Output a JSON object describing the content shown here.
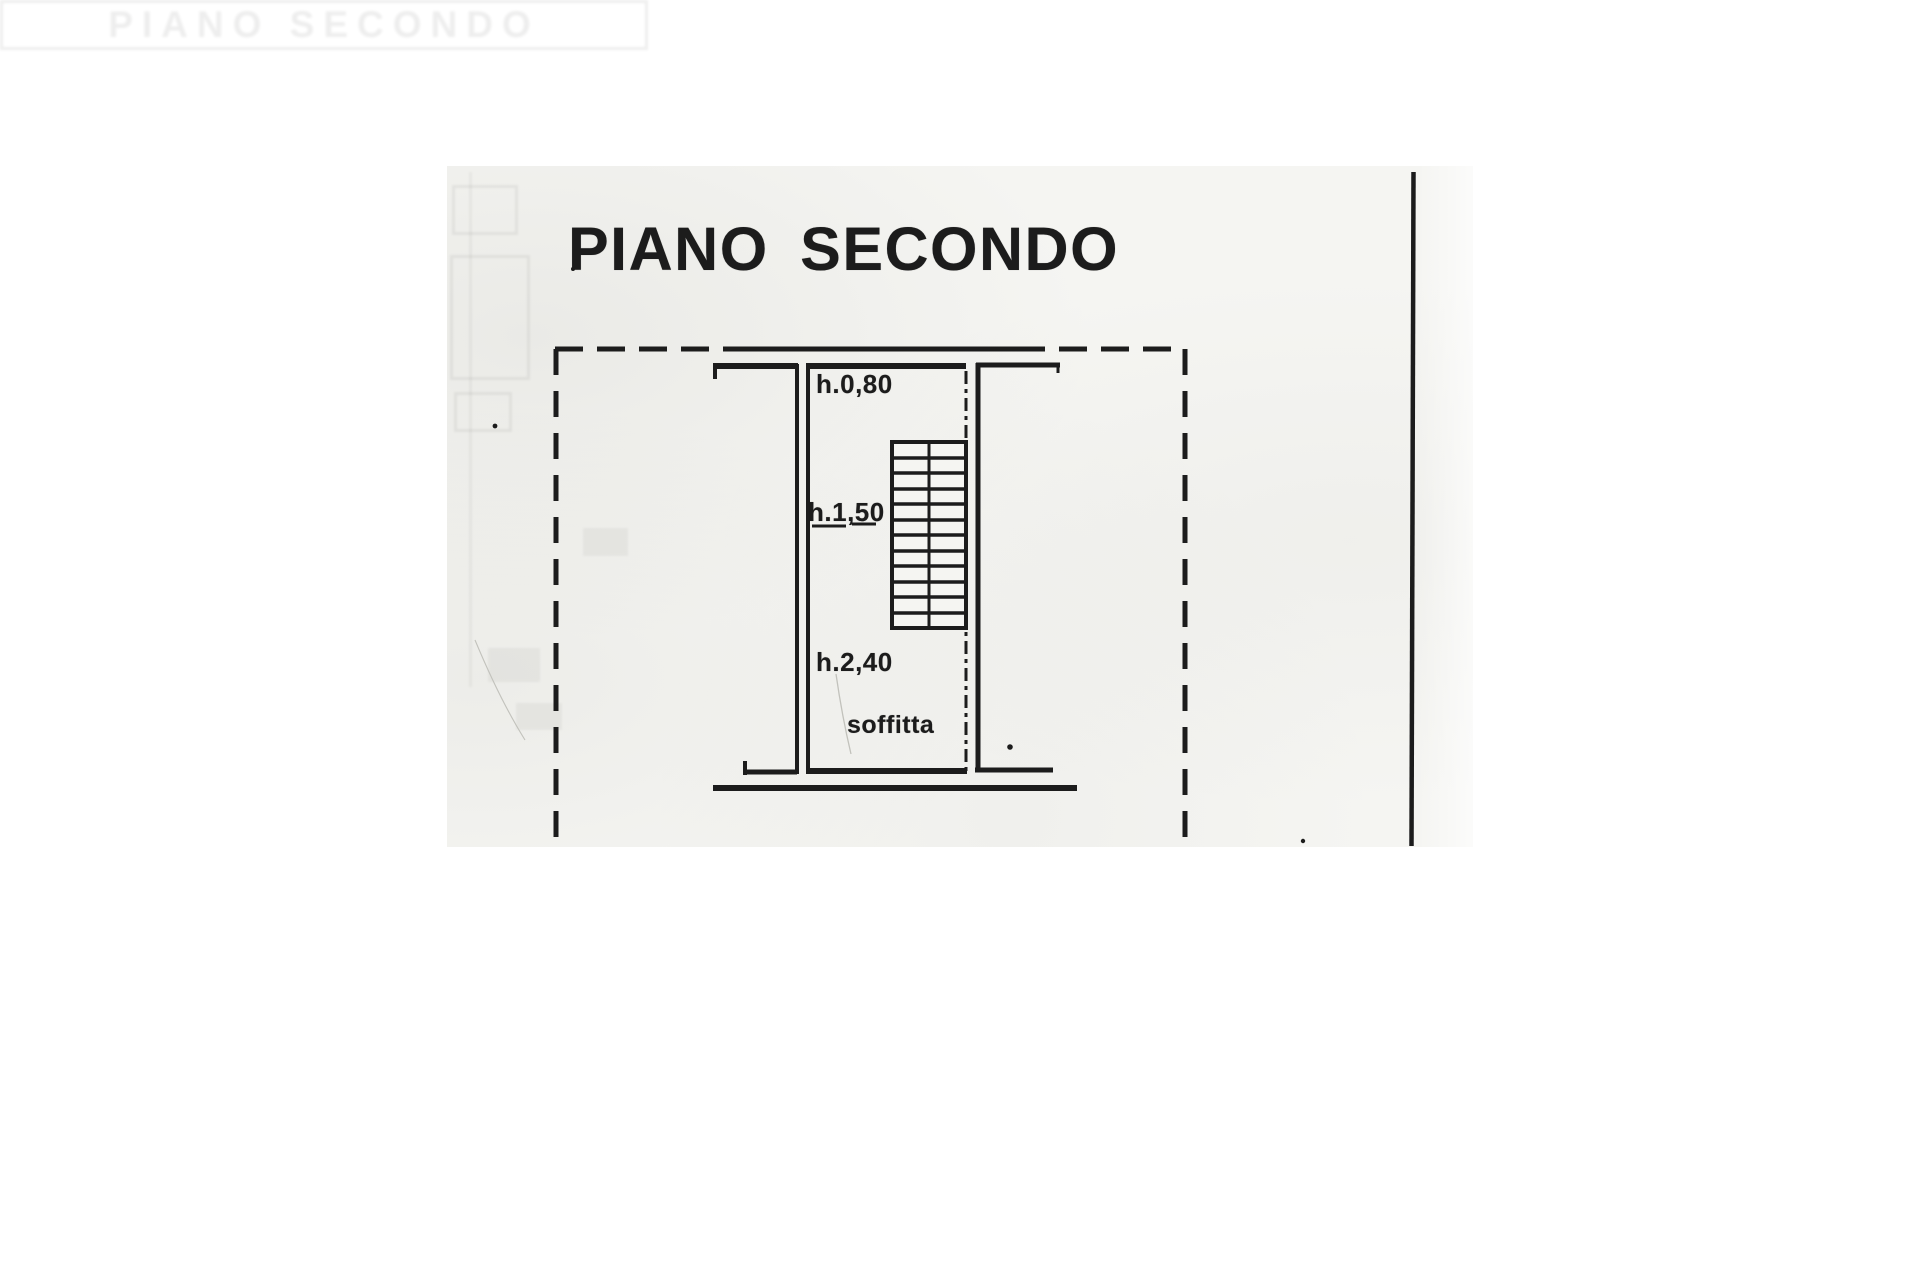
{
  "document_type": "scanned cadastral floor plan page",
  "plan": {
    "title": "PIANO SECONDO",
    "labels": {
      "h_top": "h.0,80",
      "h_mid": "h.1,50",
      "h_bot": "h.2,40",
      "room": "soffitta"
    },
    "ghost_text": "PIANO SECONDO",
    "colors": {
      "ink": "#1c1c1c",
      "paper": "#f5f5f2",
      "page": "#ffffff"
    }
  }
}
